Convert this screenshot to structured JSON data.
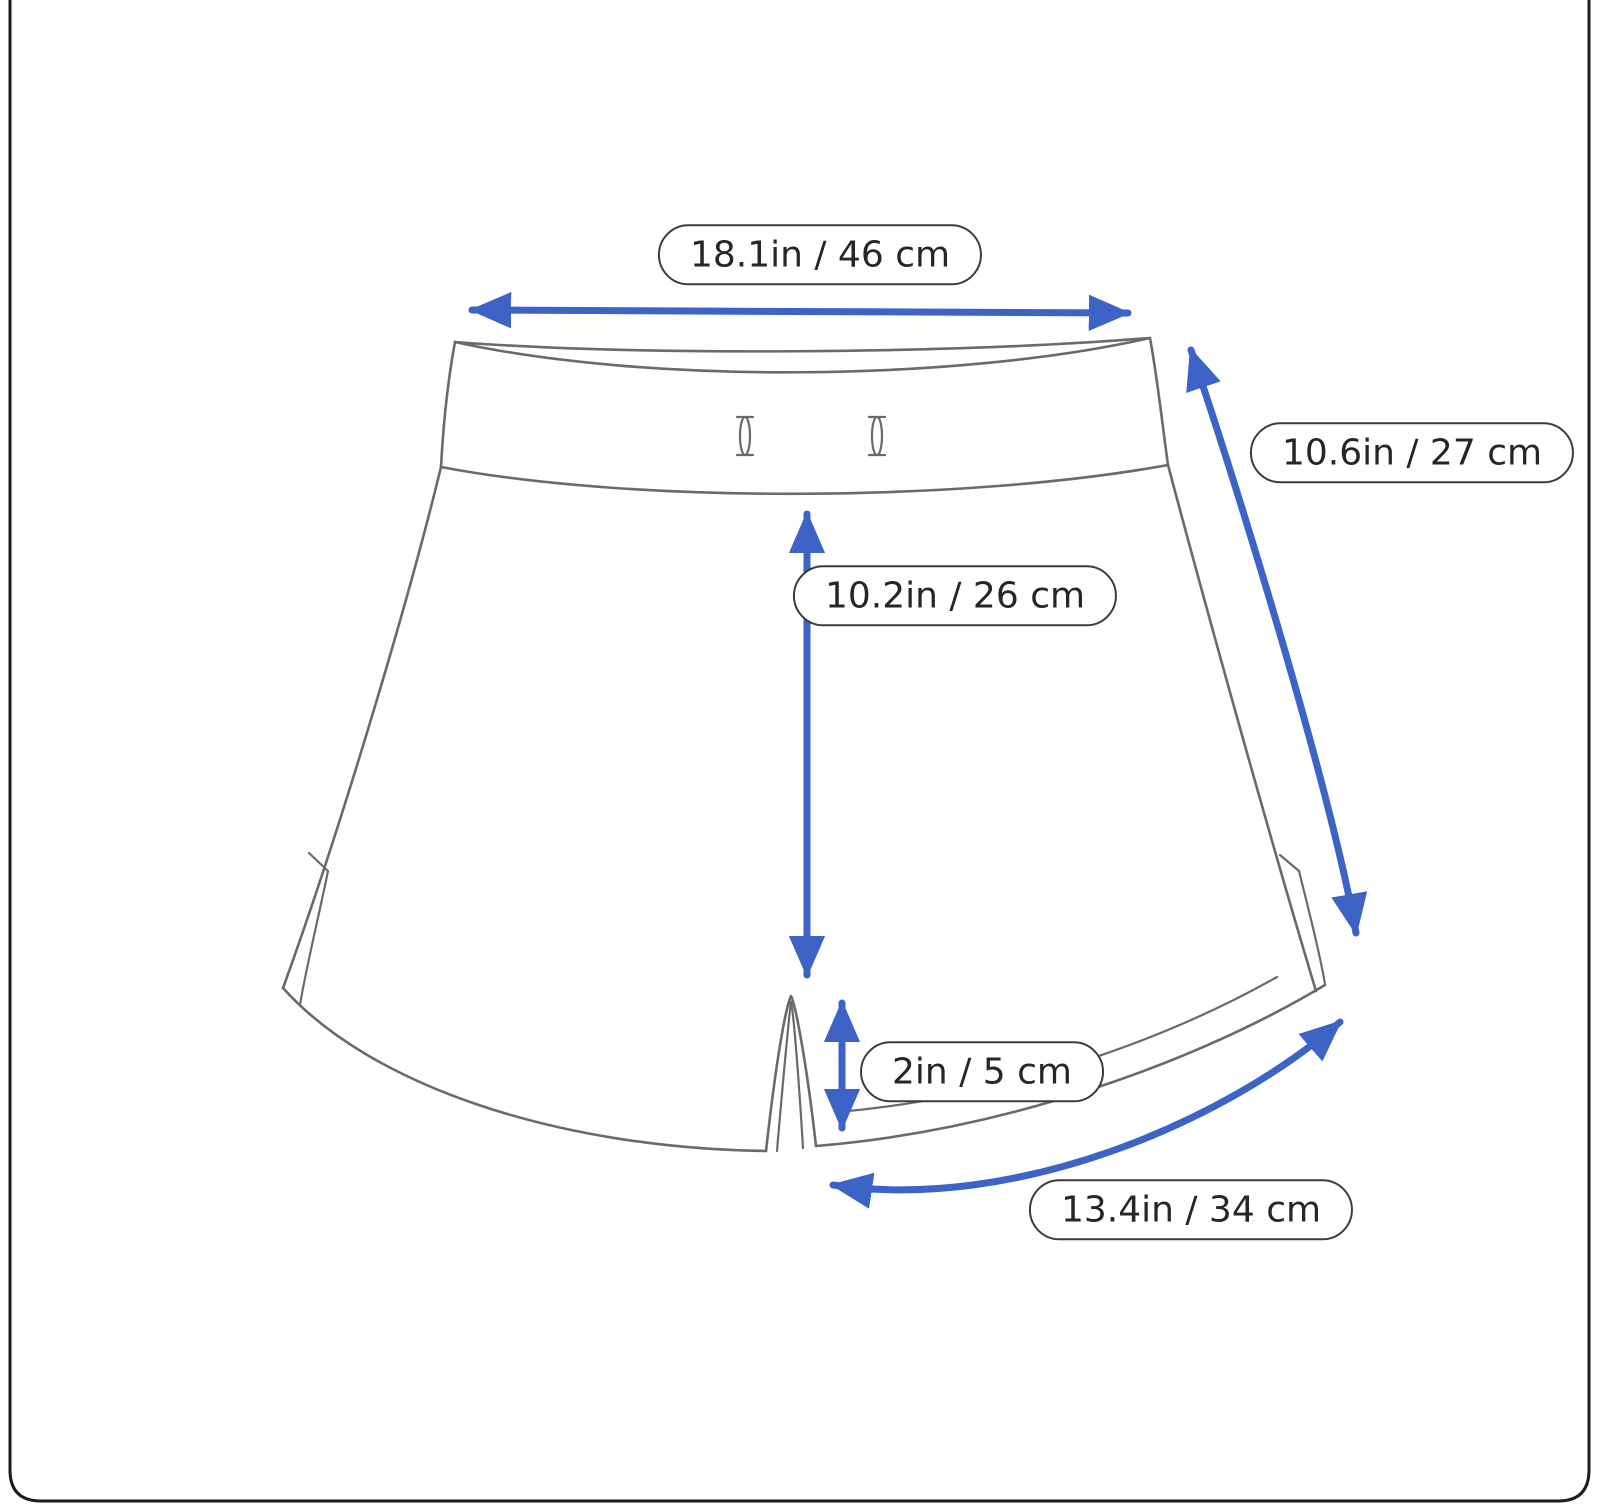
{
  "measurements": {
    "waist_width": "18.1in / 46 cm",
    "side_length": "10.6in / 27 cm",
    "front_length": "10.2in / 26 cm",
    "inseam": "2in / 5 cm",
    "leg_opening": "13.4in / 34 cm"
  },
  "colors": {
    "arrow": "#3d63c6",
    "outline": "#6a6a6a",
    "label_border": "#3c3c3c",
    "label_text": "#262626",
    "background": "#ffffff",
    "frame_border": "#1c1c1c"
  }
}
